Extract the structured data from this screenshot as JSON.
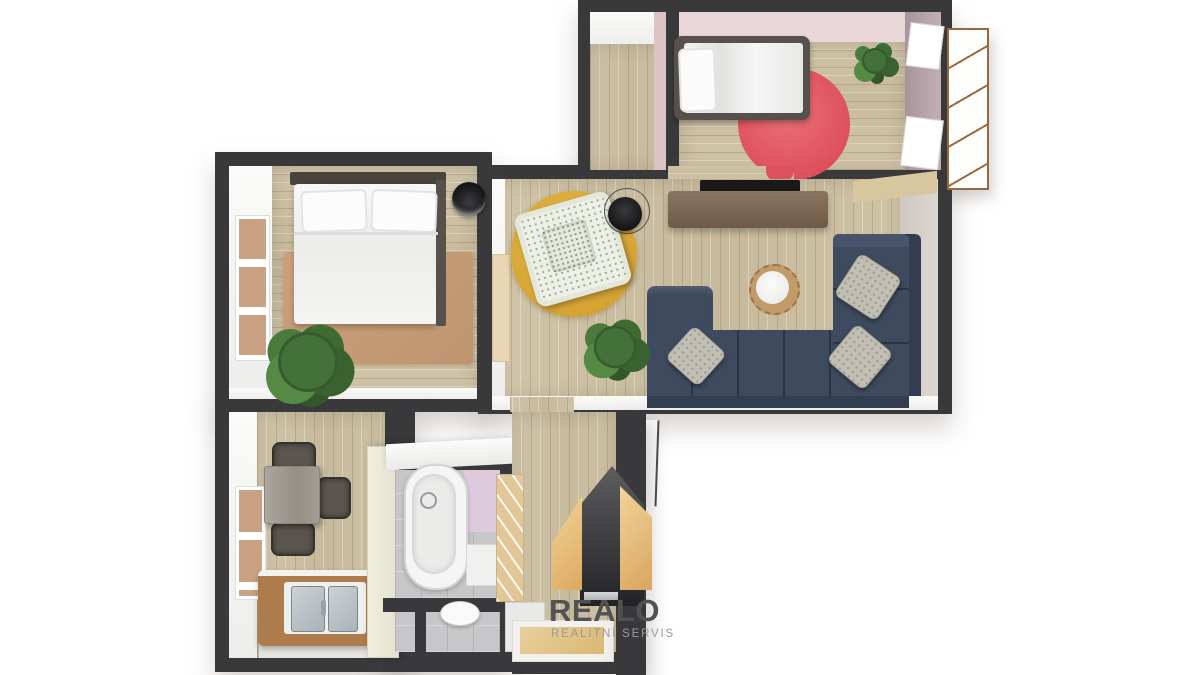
{
  "watermark": {
    "brand": "REALO",
    "tagline": "REALITNÍ SERVIS",
    "logo_icon": "split-house-icon"
  },
  "scene": {
    "type": "3d-floor-plan-render",
    "rooms": [
      {
        "name": "kids-bedroom",
        "furniture": [
          "single-bed",
          "pillow",
          "round-red-rug",
          "potted-plant",
          "window-panel-upper",
          "window-panel-lower",
          "wardrobe",
          "closet-nook"
        ]
      },
      {
        "name": "living-room",
        "furniture": [
          "corner-sofa",
          "sofa-cushions",
          "wall-tv",
          "tv-console",
          "round-side-table",
          "yellow-round-rug",
          "floral-armchair",
          "floor-lamp",
          "potted-plant",
          "cream-door"
        ]
      },
      {
        "name": "bedroom",
        "furniture": [
          "double-bed",
          "two-pillows",
          "tan-rug",
          "potted-plant",
          "floor-lamp",
          "window"
        ]
      },
      {
        "name": "kitchen",
        "furniture": [
          "dining-table",
          "three-chairs",
          "counter-with-double-sink",
          "tall-cream-cabinet",
          "window"
        ]
      },
      {
        "name": "bathroom",
        "furniture": [
          "bathtub",
          "lavender-wall-panel",
          "small-cabinet"
        ]
      },
      {
        "name": "wc",
        "furniture": [
          "toilet"
        ]
      },
      {
        "name": "hallway",
        "furniture": [
          "louvered-wardrobe",
          "doormat",
          "white-door"
        ]
      },
      {
        "name": "balcony-shelf",
        "furniture": [
          "open-shelf-unit"
        ]
      }
    ]
  },
  "palette": {
    "background": "#ffffff",
    "wall": "#39393b",
    "wall_inner_face": "#f7f7f5",
    "wood_floor": "#ccc0a4",
    "pink_wall": "#ead7d9",
    "mauve_wall": "#b3a0a7",
    "red_rug": "#e25862",
    "yellow_rug": "#d9a93a",
    "tan_rug": "#c59b76",
    "navy_sofa": "#3e4a5e",
    "pillow_gray_beige": "#c1beb3",
    "armchair_floral": "#eef0e8",
    "tv_console": "#7b6651",
    "tv_screen": "#1b1b1b",
    "dining_table": "#a8a29b",
    "chair": "#5b554f",
    "counter_wood": "#ad7c4c",
    "sink_steel": "#bfc6cb",
    "cream_cabinet": "#ecead8",
    "bath_floor": "#c7c7c9",
    "lavender_panel": "#decadd",
    "tub": "#f5f5f5",
    "plant_green": "#44713a",
    "logo_beige": "#eac287",
    "logo_dark_house": "#3f3f41",
    "brand_text": "#515254",
    "tagline_text": "#9a9a9c"
  }
}
